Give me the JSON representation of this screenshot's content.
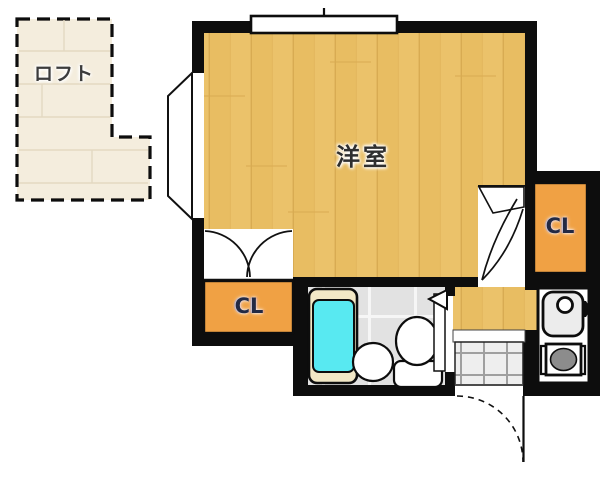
{
  "floorplan": {
    "rooms": {
      "loft": {
        "label": "ロフト"
      },
      "main_room": {
        "label": "洋室"
      },
      "closet_left": {
        "label": "CL"
      },
      "closet_right": {
        "label": "CL"
      }
    },
    "colors": {
      "wood_floor": "#ebc26a",
      "closet_orange": "#f0a144",
      "loft_floor": "#f4eddd",
      "bathtub_cyan": "#58e9f1",
      "tub_rim": "#f2e8c6",
      "bath_tile": "#e2e2e2",
      "genkan_tile": "#eeeeee",
      "wall_black": "#0d0d0d",
      "stove_gray": "#8c8c8c"
    },
    "fixtures": [
      "window",
      "bay-window",
      "double-closet-door",
      "room-door",
      "bathroom-door",
      "bathtub",
      "washbasin",
      "toilet",
      "kitchen-sink",
      "stove-burner",
      "entrance-door"
    ]
  }
}
